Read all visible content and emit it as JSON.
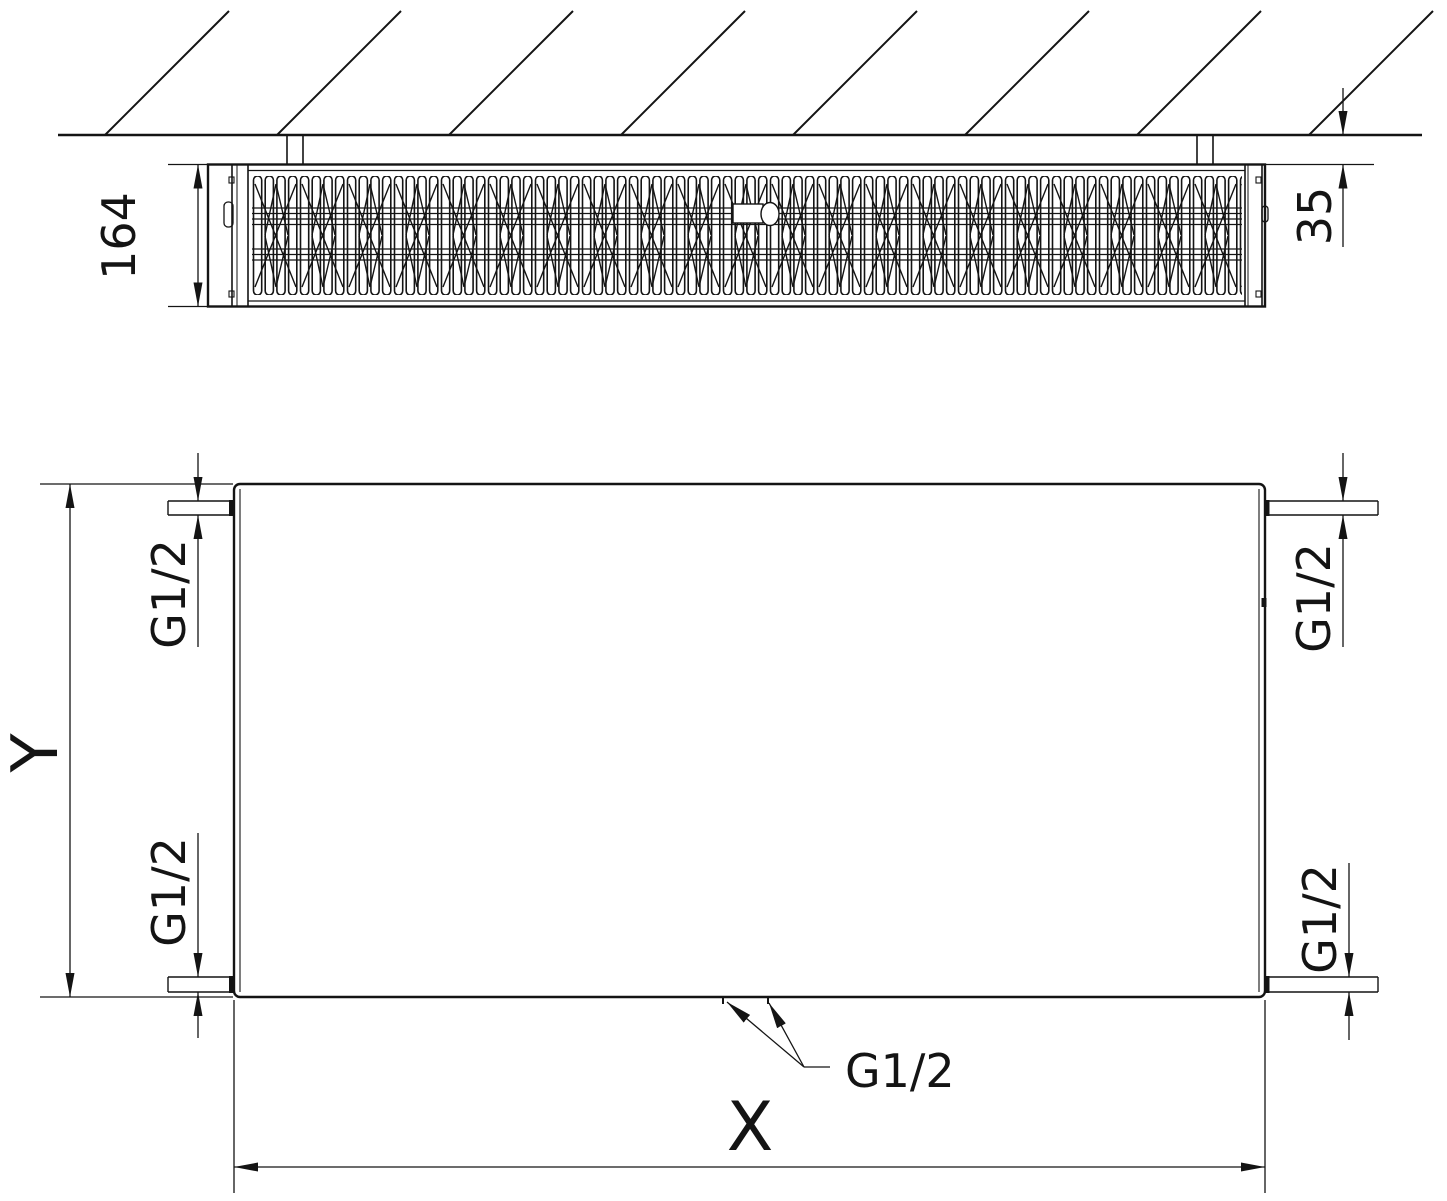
{
  "figure": {
    "type": "technical-drawing",
    "subject": "wall-mounted panel radiator — side cross-section and front elevation with dimensions"
  },
  "dimensions": {
    "depth": "164",
    "wall_offset": "35",
    "height": "Y",
    "width": "X"
  },
  "connections": {
    "top_left": "G1/2",
    "bottom_left": "G1/2",
    "top_right": "G1/2",
    "bottom_right": "G1/2",
    "bottom_center": "G1/2"
  },
  "colors": {
    "line": "#141414",
    "background": "#ffffff"
  }
}
